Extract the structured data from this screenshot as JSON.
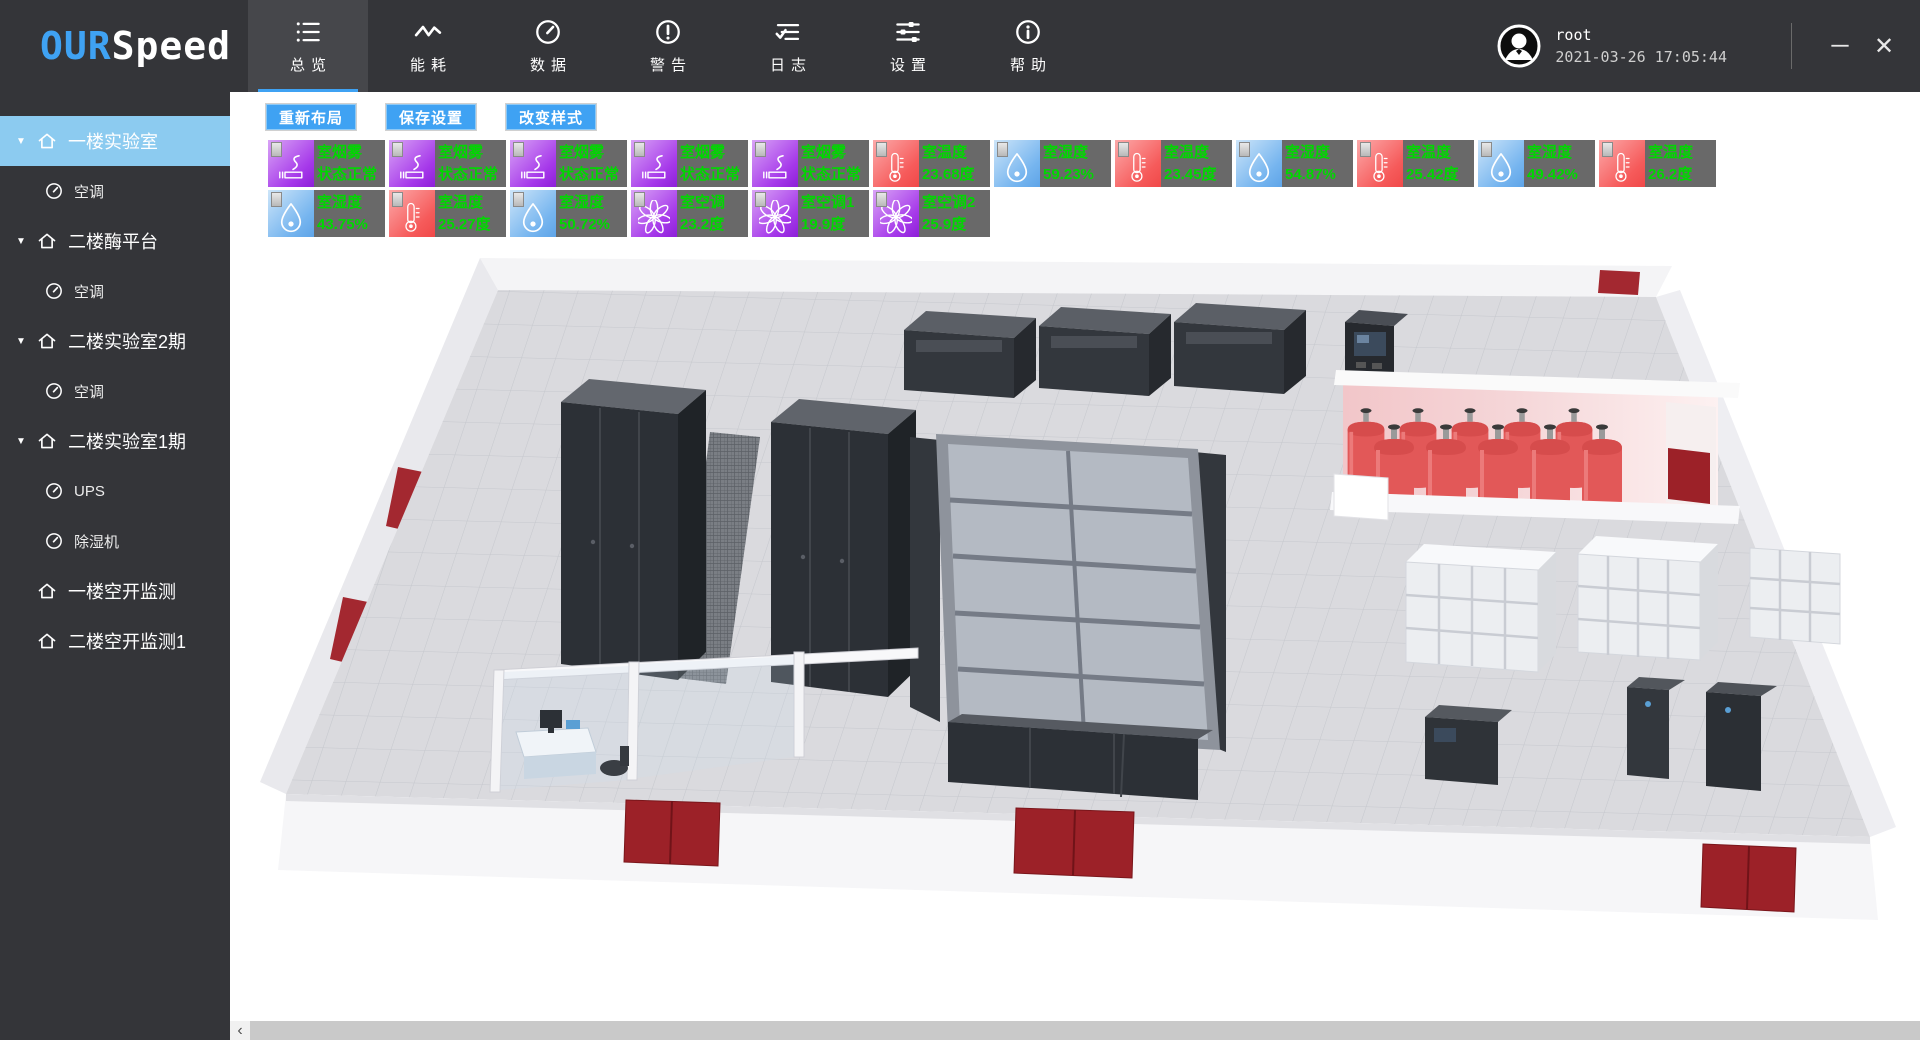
{
  "app": {
    "logo_primary": "OUR",
    "logo_secondary": "Speed",
    "user_name": "root",
    "timestamp": "2021-03-26 17:05:44"
  },
  "icons_glyphs": {
    "minimize": "─",
    "close": "✕",
    "expand_arrow": "▼",
    "scroll_left": "‹"
  },
  "colors": {
    "accent": "#3fa2f3",
    "sidebar_selected": "#8ccbf0",
    "badge_green": "#00d800",
    "smoke_purple": "#a639ea",
    "temp_red": "#f65b5b",
    "humidity_blue": "#76b5ef",
    "door_red": "#9c2128"
  },
  "nav": {
    "items": [
      {
        "id": "overview",
        "label": "总览",
        "icon": "list",
        "active": true
      },
      {
        "id": "energy",
        "label": "能耗",
        "icon": "pulse",
        "active": false
      },
      {
        "id": "data",
        "label": "数据",
        "icon": "gauge",
        "active": false
      },
      {
        "id": "alerts",
        "label": "警告",
        "icon": "warning",
        "active": false
      },
      {
        "id": "logs",
        "label": "日志",
        "icon": "log",
        "active": false
      },
      {
        "id": "settings",
        "label": "设置",
        "icon": "sliders",
        "active": false
      },
      {
        "id": "help",
        "label": "帮助",
        "icon": "info",
        "active": false
      }
    ]
  },
  "sidebar": {
    "items": [
      {
        "id": "floor1-lab",
        "label": "一楼实验室",
        "level": 0,
        "expandable": true,
        "selected": true
      },
      {
        "id": "floor1-lab-ac",
        "label": "空调",
        "level": 1,
        "expandable": false,
        "selected": false
      },
      {
        "id": "floor2-enzyme",
        "label": "二楼酶平台",
        "level": 0,
        "expandable": true,
        "selected": false
      },
      {
        "id": "floor2-enzyme-ac",
        "label": "空调",
        "level": 1,
        "expandable": false,
        "selected": false
      },
      {
        "id": "floor2-lab-phase2",
        "label": "二楼实验室2期",
        "level": 0,
        "expandable": true,
        "selected": false
      },
      {
        "id": "floor2-lab-p2-ac",
        "label": "空调",
        "level": 1,
        "expandable": false,
        "selected": false
      },
      {
        "id": "floor2-lab-phase1",
        "label": "二楼实验室1期",
        "level": 0,
        "expandable": true,
        "selected": false
      },
      {
        "id": "floor2-lab-p1-ups",
        "label": "UPS",
        "level": 1,
        "expandable": false,
        "selected": false
      },
      {
        "id": "floor2-lab-p1-dehum",
        "label": "除湿机",
        "level": 1,
        "expandable": false,
        "selected": false
      },
      {
        "id": "floor1-breaker",
        "label": "一楼空开监测",
        "level": 0,
        "expandable": false,
        "selected": false
      },
      {
        "id": "floor2-breaker",
        "label": "二楼空开监测1",
        "level": 0,
        "expandable": false,
        "selected": false
      }
    ]
  },
  "toolbar": {
    "buttons": [
      {
        "id": "relayout",
        "label": "重新布局"
      },
      {
        "id": "save-settings",
        "label": "保存设置"
      },
      {
        "id": "change-style",
        "label": "改变样式"
      }
    ]
  },
  "sensors": {
    "rows": [
      [
        {
          "type": "smoke",
          "label": "室烟雾",
          "value": "状态正常"
        },
        {
          "type": "smoke",
          "label": "室烟雾",
          "value": "状态正常"
        },
        {
          "type": "smoke",
          "label": "室烟雾",
          "value": "状态正常"
        },
        {
          "type": "smoke",
          "label": "室烟雾",
          "value": "状态正常"
        },
        {
          "type": "smoke",
          "label": "室烟雾",
          "value": "状态正常"
        },
        {
          "type": "temperature",
          "label": "室温度",
          "value": "23.68度"
        },
        {
          "type": "humidity",
          "label": "室湿度",
          "value": "59.23%"
        },
        {
          "type": "temperature",
          "label": "室温度",
          "value": "23.45度"
        },
        {
          "type": "humidity",
          "label": "室湿度",
          "value": "54.87%"
        },
        {
          "type": "temperature",
          "label": "室温度",
          "value": "25.42度"
        },
        {
          "type": "humidity",
          "label": "室湿度",
          "value": "49.42%"
        },
        {
          "type": "temperature",
          "label": "室温度",
          "value": "26.2度"
        }
      ],
      [
        {
          "type": "humidity",
          "label": "室湿度",
          "value": "43.75%"
        },
        {
          "type": "temperature",
          "label": "室温度",
          "value": "25.27度"
        },
        {
          "type": "humidity",
          "label": "室湿度",
          "value": "50.72%"
        },
        {
          "type": "ac",
          "label": "室空调",
          "value": "23.2度"
        },
        {
          "type": "ac",
          "label": "室空调1",
          "value": "19.9度"
        },
        {
          "type": "ac",
          "label": "室空调2",
          "value": "25.9度"
        }
      ]
    ]
  }
}
